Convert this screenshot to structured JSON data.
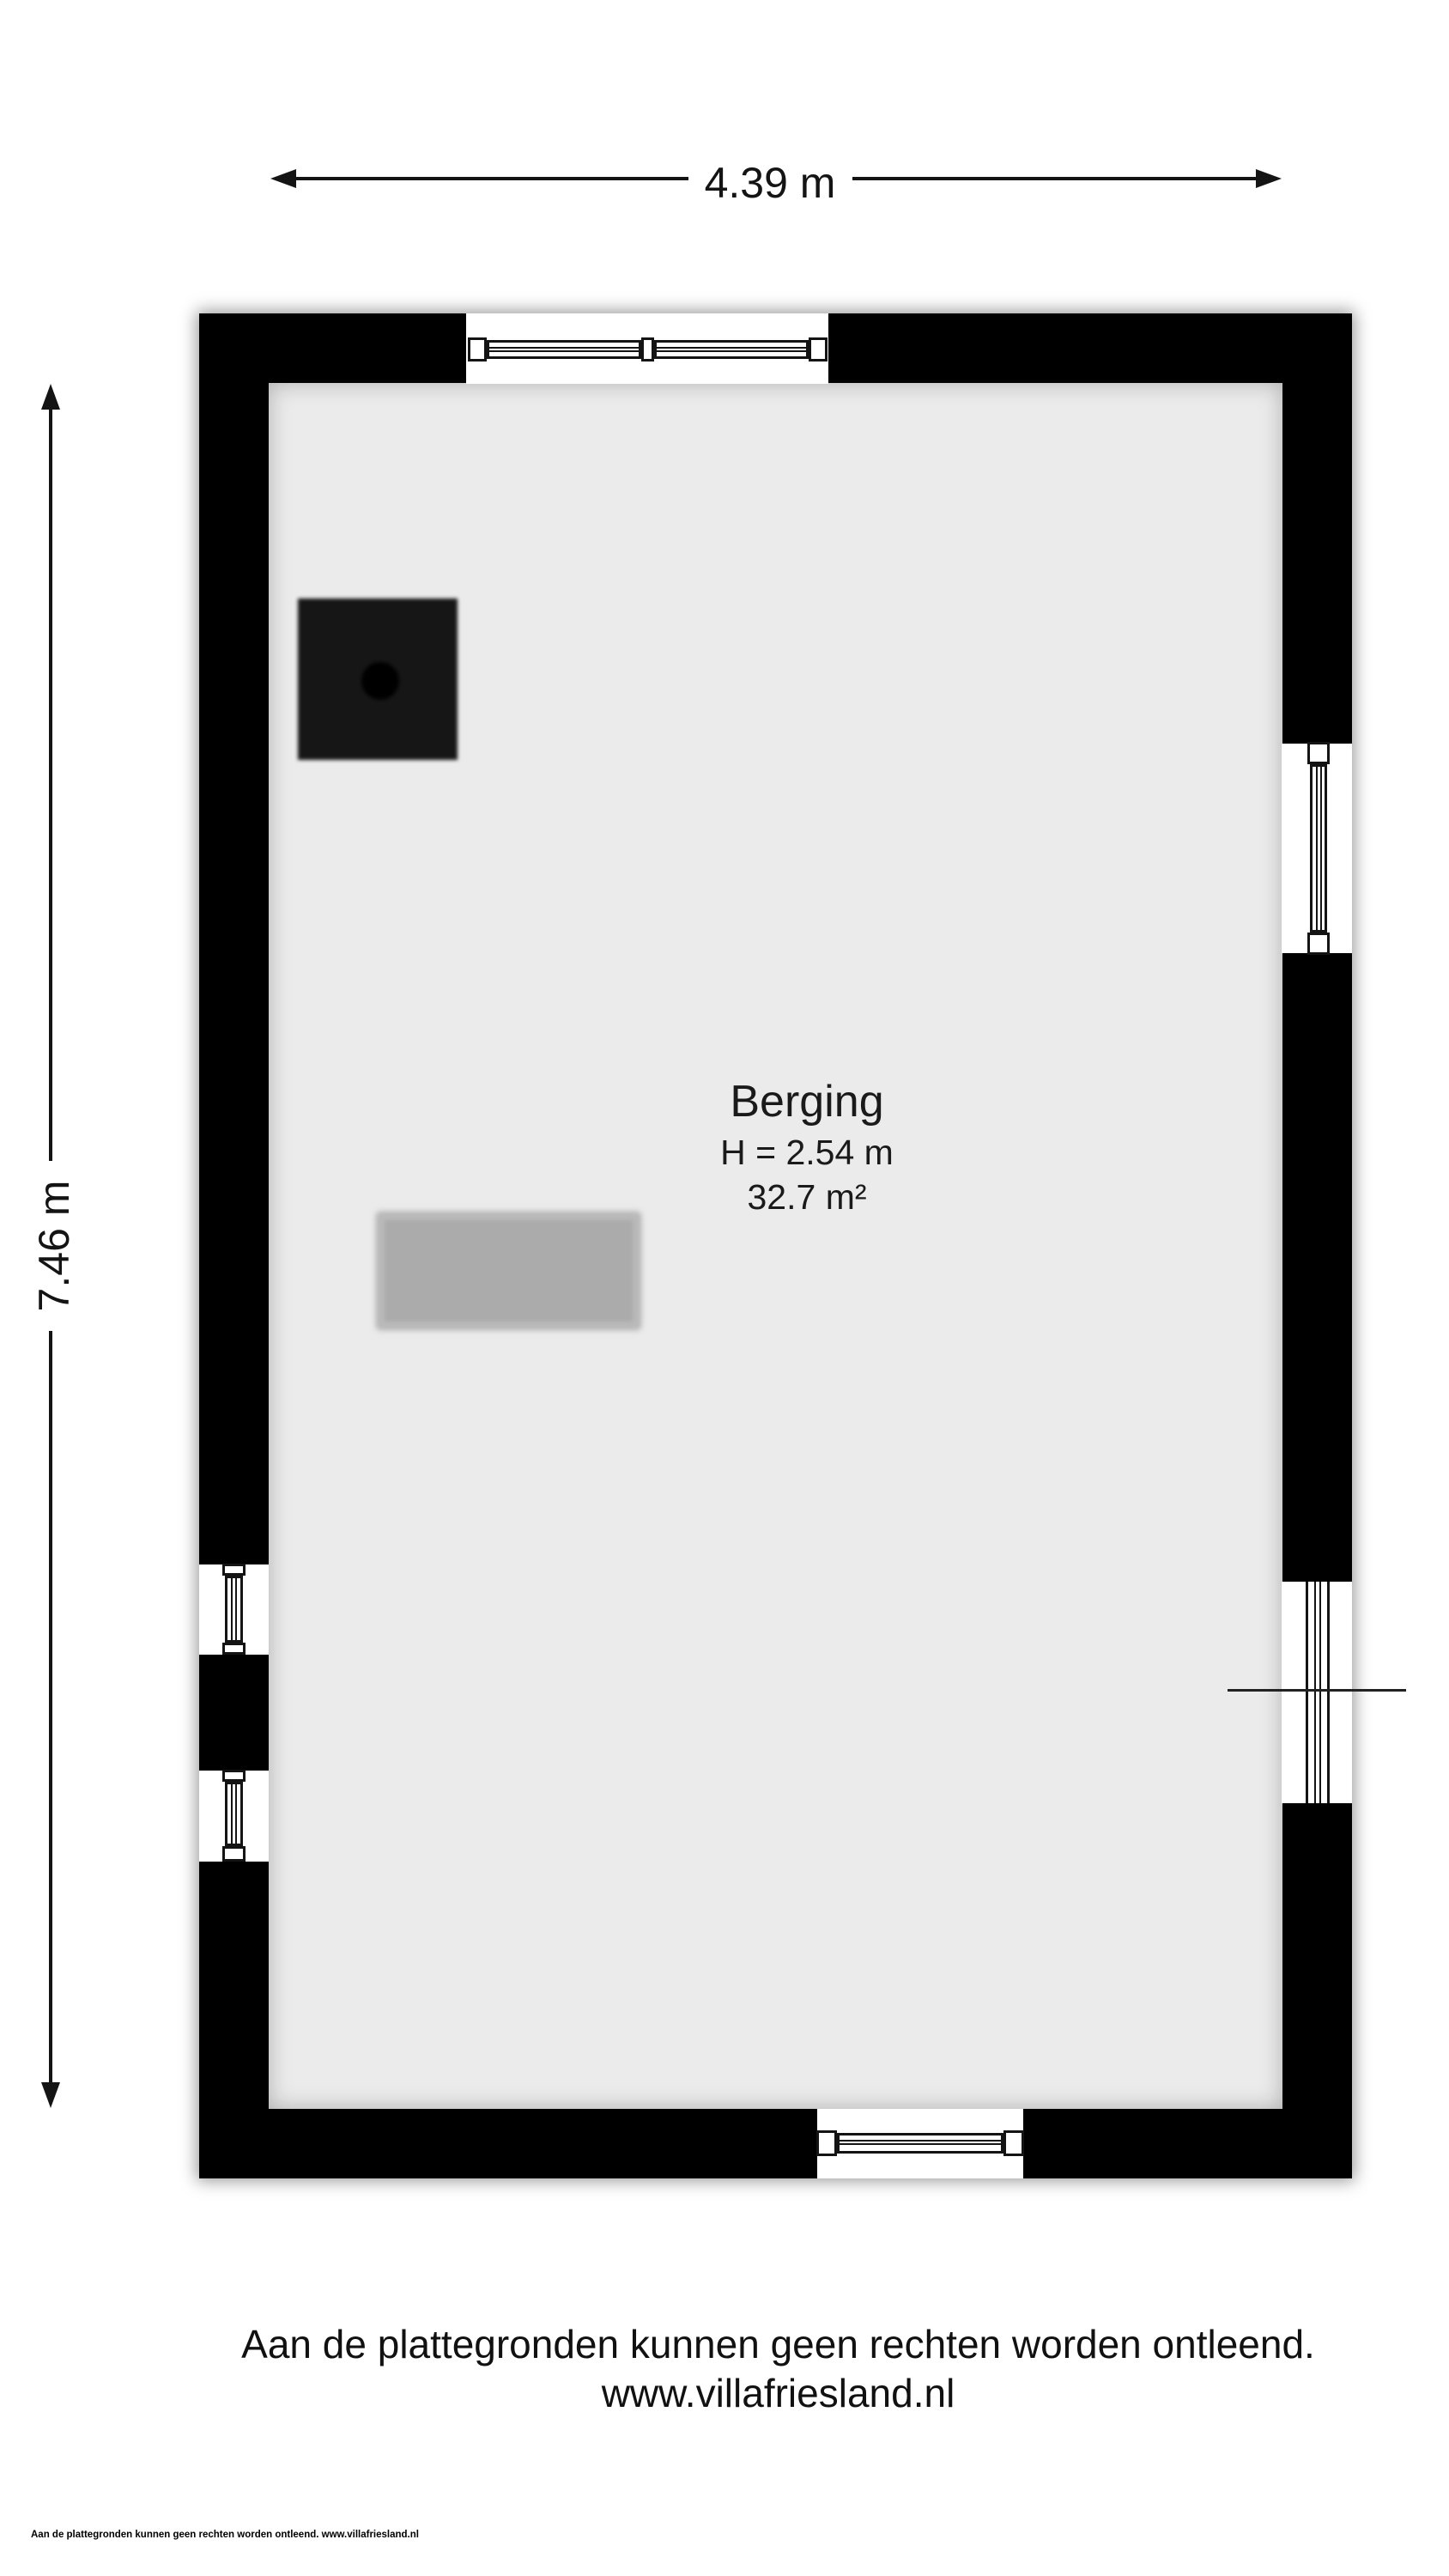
{
  "dimensions": {
    "width": "4.39 m",
    "height": "7.46 m"
  },
  "room": {
    "name": "Berging",
    "ceiling_height": "H = 2.54 m",
    "area": "32.7 m²"
  },
  "disclaimer": {
    "line1": "Aan de plattegronden kunnen geen rechten worden ontleend.",
    "line2": "www.villafriesland.nl"
  },
  "footer": "Aan de plattegronden kunnen geen rechten worden ontleend. www.villafriesland.nl",
  "colors": {
    "wall": "#000000",
    "floor": "#ebebeb",
    "furniture": "#ababab",
    "stove": "#161616"
  }
}
